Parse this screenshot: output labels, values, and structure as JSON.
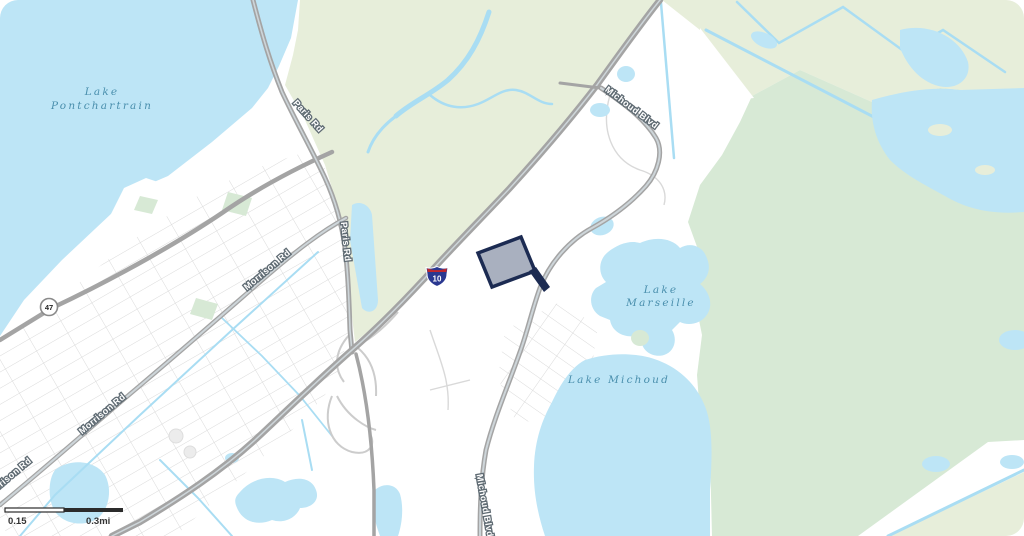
{
  "map": {
    "type": "static-parcel-map",
    "water_labels": {
      "lake_pontchartrain": [
        "Lake",
        "Pontchartrain"
      ],
      "lake_marseille": [
        "Lake",
        "Marseille"
      ],
      "lake_michoud": "Lake Michoud"
    },
    "road_labels": {
      "paris_rd": "Paris Rd",
      "morrison_rd": "Morrison Rd",
      "michoud_blvd": "Michoud Blvd"
    },
    "shields": {
      "interstate_10": "10",
      "route_47": "47"
    },
    "scale_bar": {
      "half_label": "0.15",
      "full_label": "0.3mi"
    },
    "colors": {
      "water": "#bde5f6",
      "marsh_green": "#e7eeda",
      "park_green": "#d7e9d5",
      "land": "#ffffff",
      "road_gray": "#a4a4a4",
      "parcel_fill": "#a9b0bf",
      "parcel_outline": "#1c2b52",
      "water_label_blue": "#4a8fad",
      "interstate_blue": "#2a3890",
      "interstate_red": "#c0272d"
    }
  }
}
